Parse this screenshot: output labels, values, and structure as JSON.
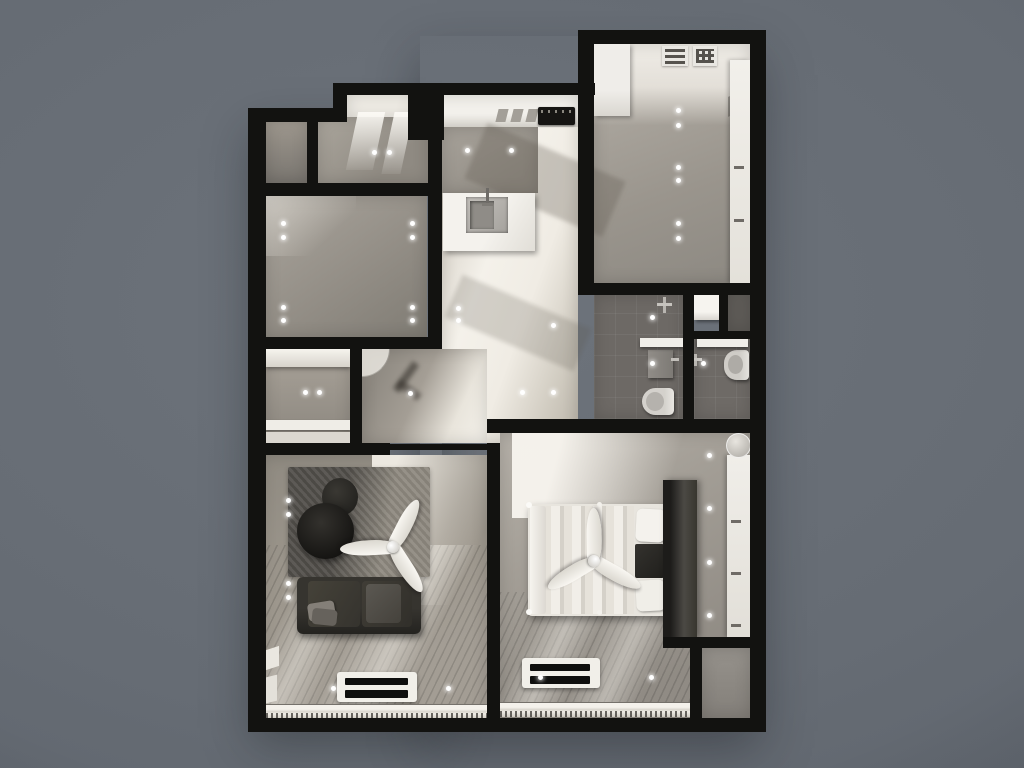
{
  "scene": {
    "description": "Top-down 3D architectural render of a one-bedroom apartment floor plan on a plain slate-gray backdrop",
    "render_type": "3d-floor-plan-top-view",
    "visible_text": ""
  },
  "palette": {
    "background": "#666c74",
    "wall": "#121210",
    "floor": "#9c968d",
    "floor_dark": "#7c7872",
    "cream": "#efebe2",
    "bath_floor": "#6d6965",
    "wood_floor": "#948d84",
    "white_furniture": "#efede8",
    "sofa": "#2f2d29",
    "table": "#1b1a18",
    "rug_dark": "#504d48",
    "rug_light": "#8e897f",
    "metal": "#b7b4af",
    "downlight": "#ffffff"
  },
  "rooms": [
    {
      "id": "utility-room",
      "name": "Utility / walk-in storage room",
      "furniture": [
        "washer",
        "dryer",
        "tall-cabinet",
        "wardrobe-doors"
      ]
    },
    {
      "id": "kitchen",
      "name": "Kitchen",
      "furniture": [
        "counter-run",
        "cooktop",
        "hood-cabinets",
        "island-with-sink"
      ]
    },
    {
      "id": "hallway",
      "name": "Hallway with sunlight band",
      "furniture": []
    },
    {
      "id": "storage-room",
      "name": "Small store room (top left)",
      "furniture": []
    },
    {
      "id": "skylight-room",
      "name": "Room with window light beams (top left)",
      "furniture": []
    },
    {
      "id": "entry-closet",
      "name": "Entry closet room",
      "furniture": [
        "upper-cabinet",
        "lower-cabinets"
      ]
    },
    {
      "id": "entry-hall",
      "name": "Entry vestibule",
      "furniture": [
        "entry-door-swing"
      ]
    },
    {
      "id": "bathroom-main",
      "name": "Main bathroom",
      "furniture": [
        "shower-mixer",
        "floating-counter",
        "vanity-sink",
        "toilet"
      ]
    },
    {
      "id": "bathroom-second",
      "name": "Second bathroom",
      "furniture": [
        "floating-counter",
        "sink-mixer",
        "toilet",
        "shower-tray"
      ]
    },
    {
      "id": "living-room",
      "name": "Living room",
      "furniture": [
        "area-rug",
        "round-coffee-table",
        "decor-pouf",
        "ceiling-fan",
        "sofa-with-pillows",
        "media-console",
        "balcony-railing"
      ]
    },
    {
      "id": "bedroom",
      "name": "Bedroom",
      "furniture": [
        "double-bed",
        "pillows",
        "dark-throw",
        "ceiling-fan",
        "headboard-partition",
        "ac-console",
        "balcony-railing"
      ]
    },
    {
      "id": "walkin-wardrobe",
      "name": "Bedroom walk-in wardrobe",
      "furniture": [
        "wardrobe-doors",
        "glass-stool"
      ]
    },
    {
      "id": "service-nook",
      "name": "Service nook (bottom right)",
      "furniture": []
    }
  ],
  "downlights": [
    [
      374,
      152
    ],
    [
      389,
      152
    ],
    [
      283,
      223
    ],
    [
      283,
      237
    ],
    [
      412,
      223
    ],
    [
      412,
      237
    ],
    [
      283,
      307
    ],
    [
      283,
      320
    ],
    [
      412,
      307
    ],
    [
      412,
      320
    ],
    [
      467,
      150
    ],
    [
      511,
      150
    ],
    [
      458,
      308
    ],
    [
      458,
      320
    ],
    [
      553,
      325
    ],
    [
      522,
      392
    ],
    [
      553,
      392
    ],
    [
      410,
      393
    ],
    [
      305,
      392
    ],
    [
      319,
      392
    ],
    [
      678,
      110
    ],
    [
      678,
      125
    ],
    [
      678,
      167
    ],
    [
      678,
      180
    ],
    [
      678,
      223
    ],
    [
      678,
      238
    ],
    [
      652,
      317
    ],
    [
      652,
      363
    ],
    [
      703,
      363
    ],
    [
      288,
      500
    ],
    [
      288,
      514
    ],
    [
      288,
      583
    ],
    [
      288,
      597
    ],
    [
      333,
      688
    ],
    [
      448,
      688
    ],
    [
      540,
      677
    ],
    [
      651,
      677
    ],
    [
      709,
      455
    ],
    [
      709,
      508
    ],
    [
      709,
      562
    ],
    [
      709,
      615
    ]
  ]
}
